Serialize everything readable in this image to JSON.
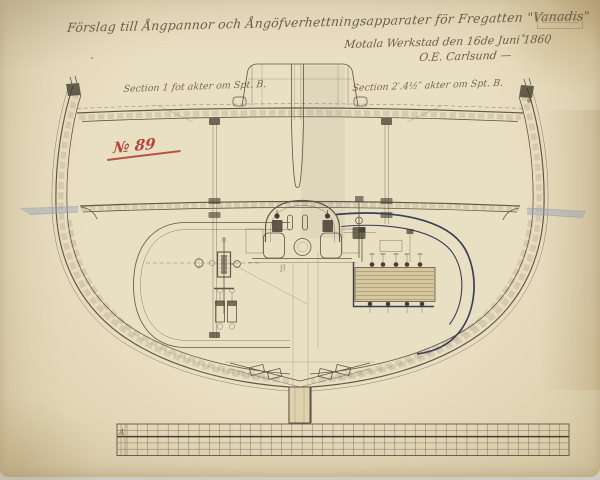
{
  "doc": {
    "title": "Förslag till Ångpannor och Ångöfverhettningsapparater för Fregatten \"Vanadis\"",
    "place_date": "Motala Werkstad den 16de Juni 1860",
    "signature": "O.E. Carlsund —",
    "drawing_number": "№ 89",
    "section_left": "Section 1 fot akter om Spt. B.",
    "section_right": "Section 2′.4½″ akter om Spt. B.",
    "grate_mark": "A",
    "pencil_note": "B"
  },
  "colors": {
    "paper": "#e9dfc2",
    "paper_edge": "#d9cba6",
    "ink": "#5f5545",
    "ink_dark": "#453e30",
    "ink_hand": "#5d4c35",
    "navy": "#3a3e58",
    "red": "#b13a2e",
    "waterline": "#97a0b5",
    "tube_fill": "#d7c79e",
    "tube_line": "#85755a"
  }
}
